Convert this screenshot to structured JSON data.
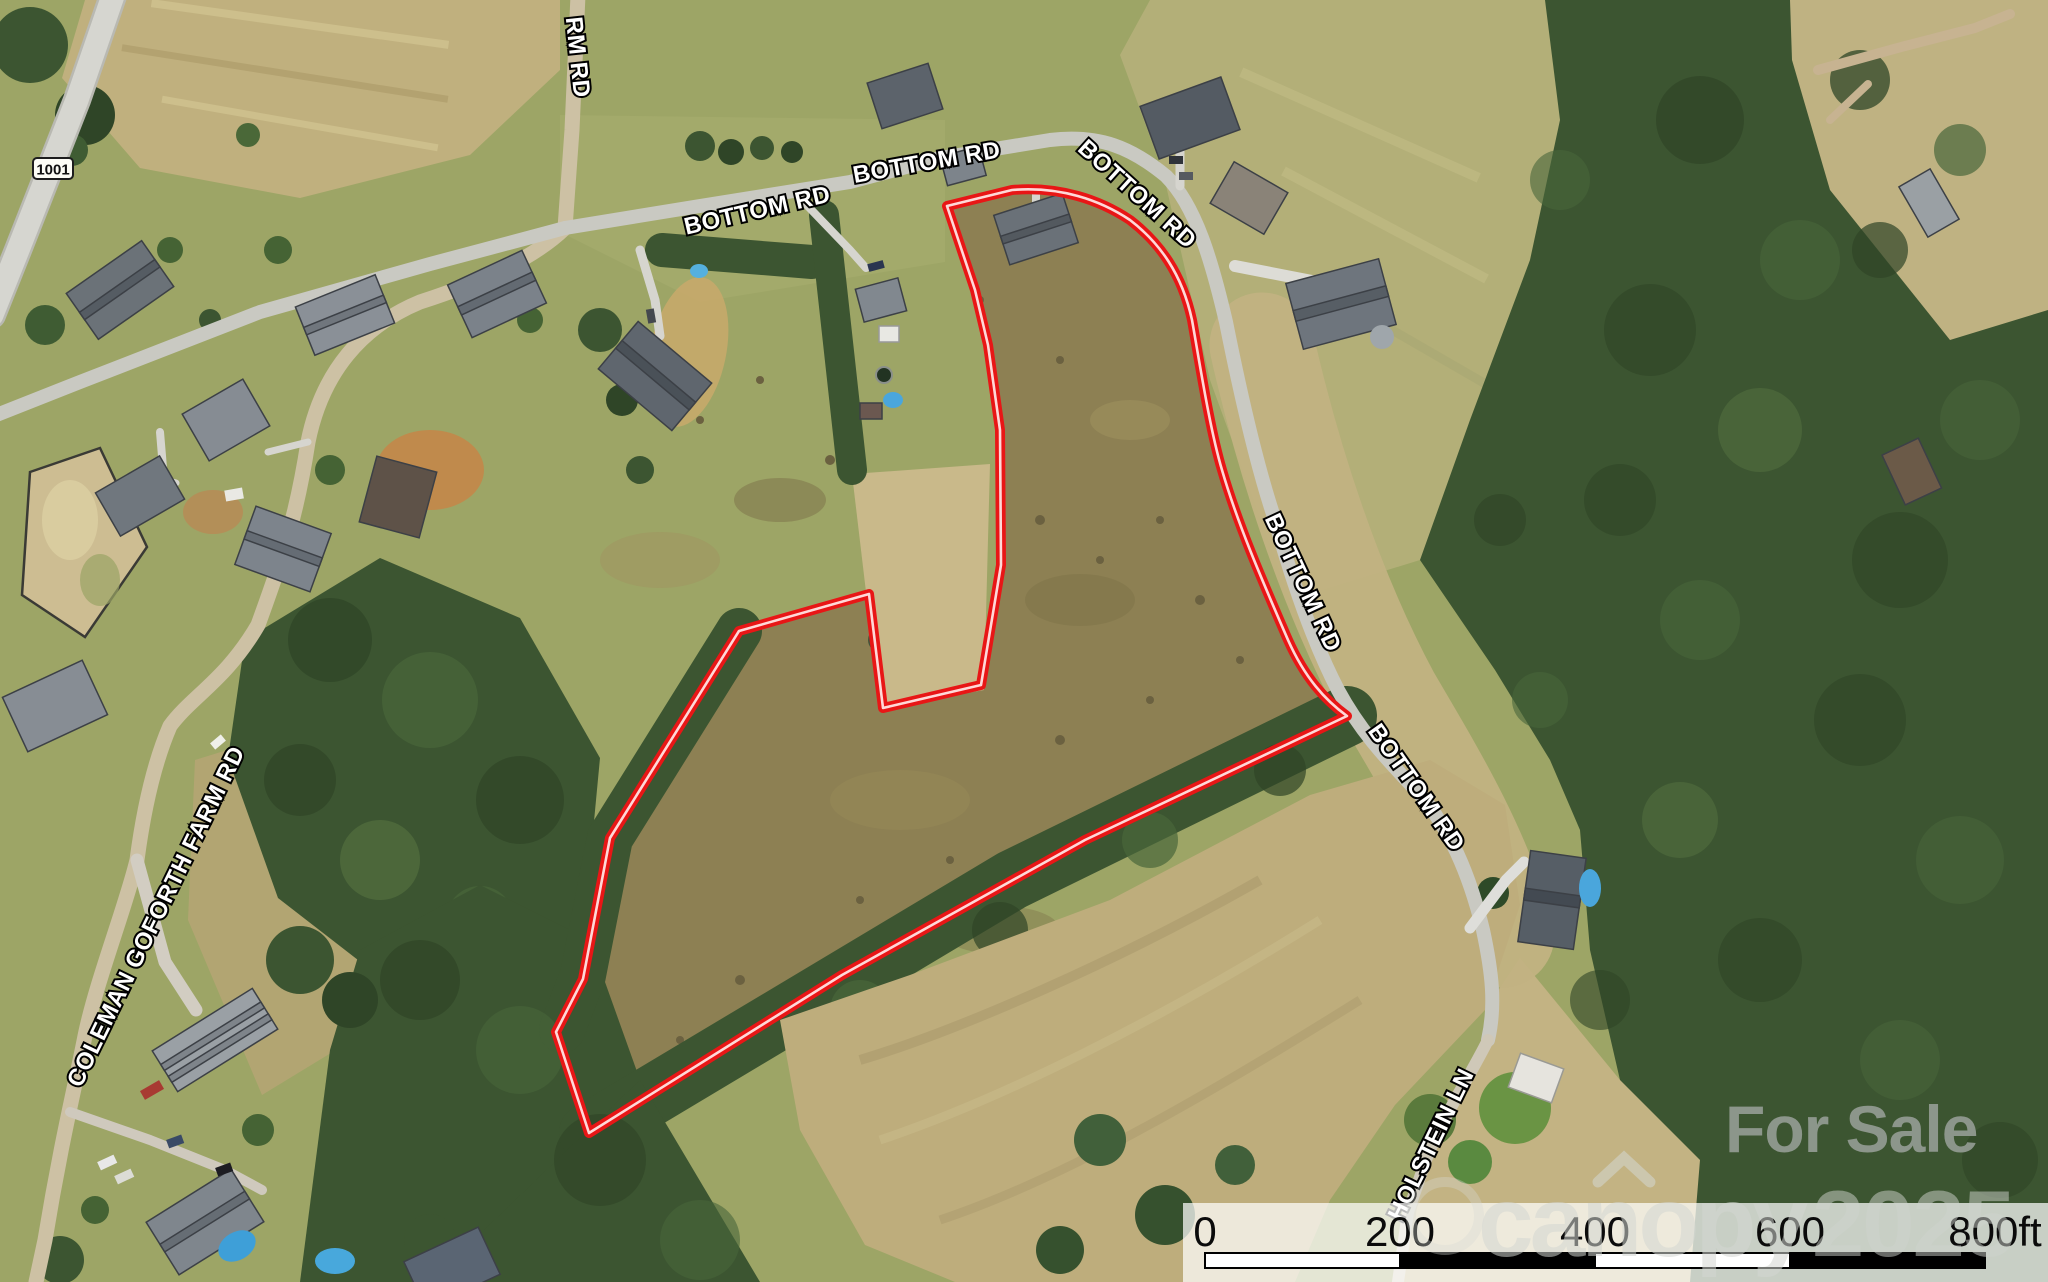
{
  "route_shield": {
    "number": "1001"
  },
  "road_labels": {
    "partial_top": "RM RD",
    "bottom_rd_1": "BOTTOM RD",
    "bottom_rd_2": "BOTTOM RD",
    "bottom_rd_3": "BOTTOM RD",
    "bottom_rd_4": "BOTTOM RD",
    "bottom_rd_5": "BOTTOM RD",
    "coleman_goforth": "COLEMAN GOFORTH FARM RD",
    "holstein": "HOLSTEIN LN"
  },
  "watermark": {
    "for_sale": "For Sale",
    "brand": "canopy",
    "year": "2025"
  },
  "scale_bar": {
    "tick_0": "0",
    "tick_200": "200",
    "tick_400": "400",
    "tick_600": "600",
    "tick_800": "800ft"
  },
  "colors": {
    "parcel_outline": "#e81616",
    "forest": "#3c5531",
    "field_tan": "#c0b07e",
    "panel_bg": "#ffffff"
  }
}
